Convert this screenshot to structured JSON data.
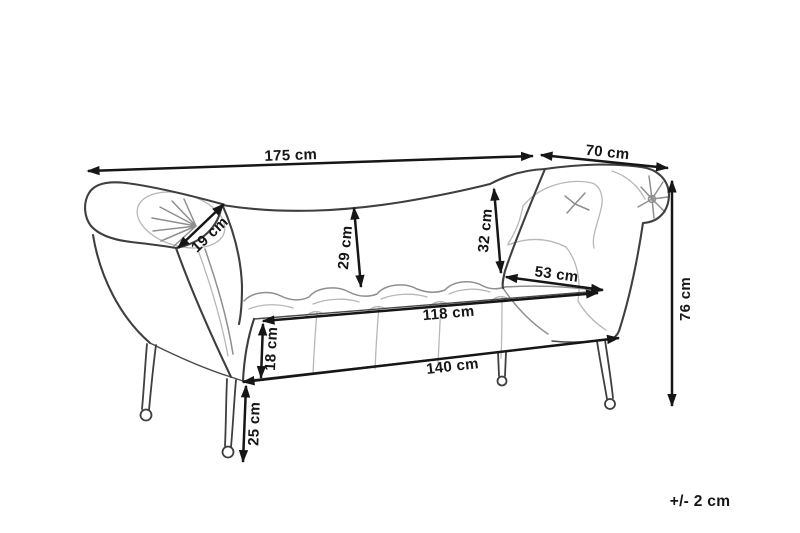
{
  "figure": {
    "dimensions": [
      {
        "id": "overall-width",
        "label": "175 cm"
      },
      {
        "id": "right-arm-depth",
        "label": "70 cm"
      },
      {
        "id": "left-armrest-roll",
        "label": "19 cm"
      },
      {
        "id": "backrest-height-left",
        "label": "29 cm"
      },
      {
        "id": "backrest-height-right",
        "label": "32 cm"
      },
      {
        "id": "seat-depth",
        "label": "53 cm"
      },
      {
        "id": "seat-top-width",
        "label": "118 cm"
      },
      {
        "id": "seat-thickness",
        "label": "18 cm"
      },
      {
        "id": "base-width",
        "label": "140 cm"
      },
      {
        "id": "leg-height",
        "label": "25 cm"
      },
      {
        "id": "overall-height",
        "label": "76 cm"
      }
    ],
    "tolerance_note": "+/- 2 cm"
  },
  "colors": {
    "background": "#ffffff",
    "outline": "#3f3f3f",
    "detail_light": "#b7b7b7",
    "detail_mid": "#8f8f8f",
    "dimension": "#161616"
  }
}
